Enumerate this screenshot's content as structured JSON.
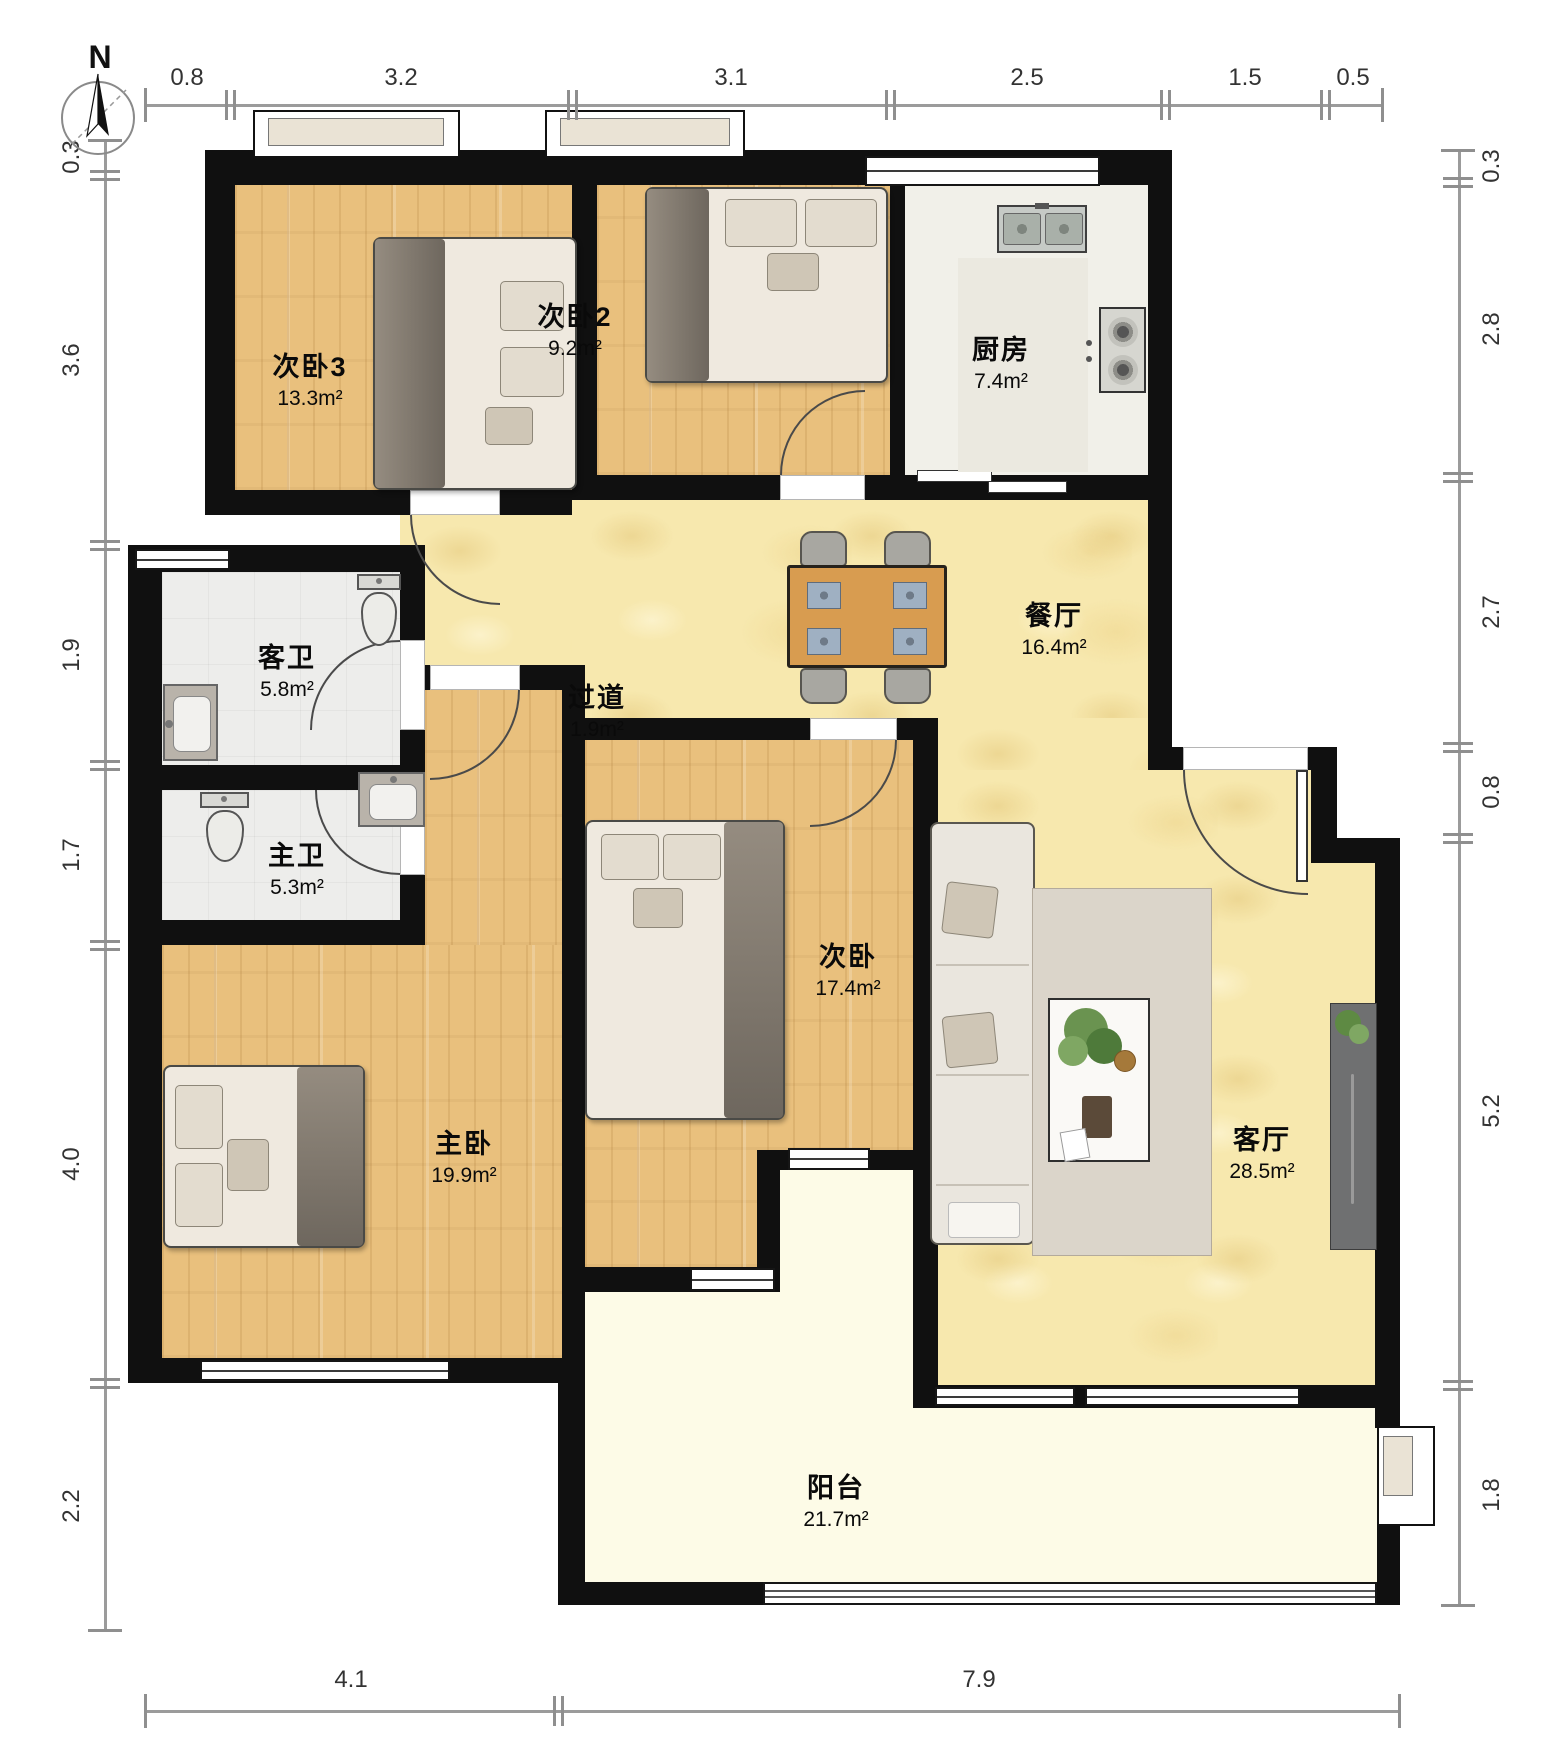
{
  "compass": {
    "label": "N"
  },
  "rooms": {
    "bedroom3": {
      "name": "次卧3",
      "area": "13.3m²"
    },
    "bedroom2": {
      "name": "次卧2",
      "area": "9.2m²"
    },
    "kitchen": {
      "name": "厨房",
      "area": "7.4m²"
    },
    "dining": {
      "name": "餐厅",
      "area": "16.4m²"
    },
    "hallway": {
      "name": "过道",
      "area": "1.9m²"
    },
    "guest_bath": {
      "name": "客卫",
      "area": "5.8m²"
    },
    "master_bath": {
      "name": "主卫",
      "area": "5.3m²"
    },
    "master_bedroom": {
      "name": "主卧",
      "area": "19.9m²"
    },
    "second_bedroom": {
      "name": "次卧",
      "area": "17.4m²"
    },
    "living": {
      "name": "客厅",
      "area": "28.5m²"
    },
    "balcony": {
      "name": "阳台",
      "area": "21.7m²"
    }
  },
  "dimensions": {
    "top": [
      "0.8",
      "3.2",
      "3.1",
      "2.5",
      "1.5",
      "0.5"
    ],
    "bottom": [
      "4.1",
      "7.9"
    ],
    "left": [
      "0.3",
      "3.6",
      "1.9",
      "1.7",
      "4.0",
      "2.2"
    ],
    "right": [
      "0.3",
      "2.8",
      "2.7",
      "0.8",
      "5.2",
      "1.8"
    ]
  },
  "colors": {
    "wall": "#101010",
    "wood_floor": "#e9c07d",
    "tile_yellow": "#f7e8ae",
    "bath_floor": "#ededeb",
    "kitchen_floor": "#f1f0e9",
    "balcony_floor": "#fdfbe7",
    "dim_line": "#9b9b9b",
    "table": "#d89c50"
  }
}
